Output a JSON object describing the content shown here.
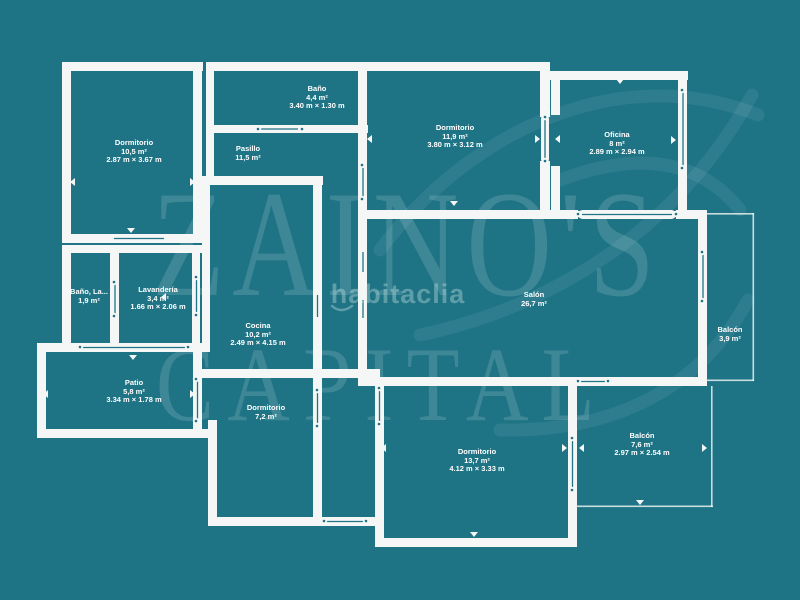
{
  "colors": {
    "background": "#1E7384",
    "wall": "#F4F7F6",
    "label_text": "#FFFFFF",
    "watermark": "rgba(218,238,241,0.18)"
  },
  "watermark": {
    "brand_line1": "ZAINO'S",
    "brand_line2": "CAPITAL",
    "portal": "habitaclia"
  },
  "rooms": [
    {
      "id": "dormitorio-1",
      "name": "Dormitorio",
      "area": "10,5 m²",
      "dims": "2.87 m × 3.67 m"
    },
    {
      "id": "bano",
      "name": "Baño",
      "area": "4,4 m²",
      "dims": "3.40 m × 1.30 m"
    },
    {
      "id": "pasillo",
      "name": "Pasillo",
      "area": "11,5 m²",
      "dims": ""
    },
    {
      "id": "dormitorio-2",
      "name": "Dormitorio",
      "area": "11,9 m²",
      "dims": "3.80 m × 3.12 m"
    },
    {
      "id": "oficina",
      "name": "Oficina",
      "area": "8 m²",
      "dims": "2.89 m × 2.94 m"
    },
    {
      "id": "bano-la",
      "name": "Baño, La...",
      "area": "1,9 m²",
      "dims": ""
    },
    {
      "id": "lavanderia",
      "name": "Lavandería",
      "area": "3,4 m²",
      "dims": "1.66 m × 2.06 m"
    },
    {
      "id": "cocina",
      "name": "Cocina",
      "area": "10,2 m²",
      "dims": "2.49 m × 4.15 m"
    },
    {
      "id": "salon",
      "name": "Salón",
      "area": "26,7 m²",
      "dims": ""
    },
    {
      "id": "balcon-1",
      "name": "Balcón",
      "area": "3,9 m²",
      "dims": ""
    },
    {
      "id": "patio",
      "name": "Patio",
      "area": "5,8 m²",
      "dims": "3.34 m × 1.78 m"
    },
    {
      "id": "dormitorio-3",
      "name": "Dormitorio",
      "area": "7,2 m²",
      "dims": ""
    },
    {
      "id": "dormitorio-4",
      "name": "Dormitorio",
      "area": "13,7 m²",
      "dims": "4.12 m × 3.33 m"
    },
    {
      "id": "balcon-2",
      "name": "Balcón",
      "area": "7,6 m²",
      "dims": "2.97 m × 2.54 m"
    }
  ]
}
